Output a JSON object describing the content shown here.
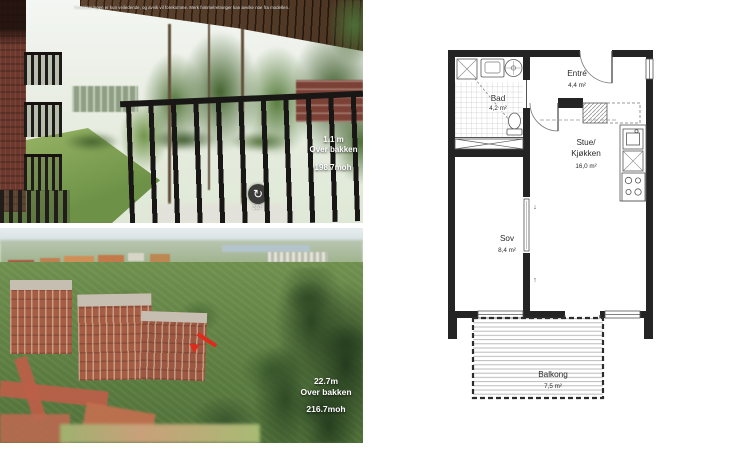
{
  "balcony_view": {
    "disclaimer": "Visualiseringen er kun veiledende, og avvik vil forekomme. Merk himmelretninger kan avvike noe fra modellen.",
    "label": {
      "height": "1.1 m",
      "caption": "Over bakken",
      "elevation": "198.7moh"
    },
    "rotate": {
      "glyph": "↻",
      "label": "360°"
    }
  },
  "aerial_view": {
    "label": {
      "height": "22.7m",
      "caption": "Over bakken",
      "elevation": "216.7moh"
    }
  },
  "floorplan": {
    "rooms": {
      "bad": {
        "name": "Bad",
        "area": "4,2 m²"
      },
      "entre": {
        "name": "Entré",
        "area": "4,4 m²"
      },
      "stue": {
        "name_line1": "Stue/",
        "name_line2": "Kjøkken",
        "area": "16,0 m²"
      },
      "sov": {
        "name": "Sov",
        "area": "8,4 m²"
      },
      "balkong": {
        "name": "Balkong",
        "area": "7,5 m²"
      }
    },
    "door_arrows": {
      "down": "↓",
      "up": "↑"
    }
  },
  "colors": {
    "wall": "#242424",
    "annotation_red": "#df2b1c",
    "overlay_text": "#ffffff",
    "brick": "#a55d43"
  }
}
